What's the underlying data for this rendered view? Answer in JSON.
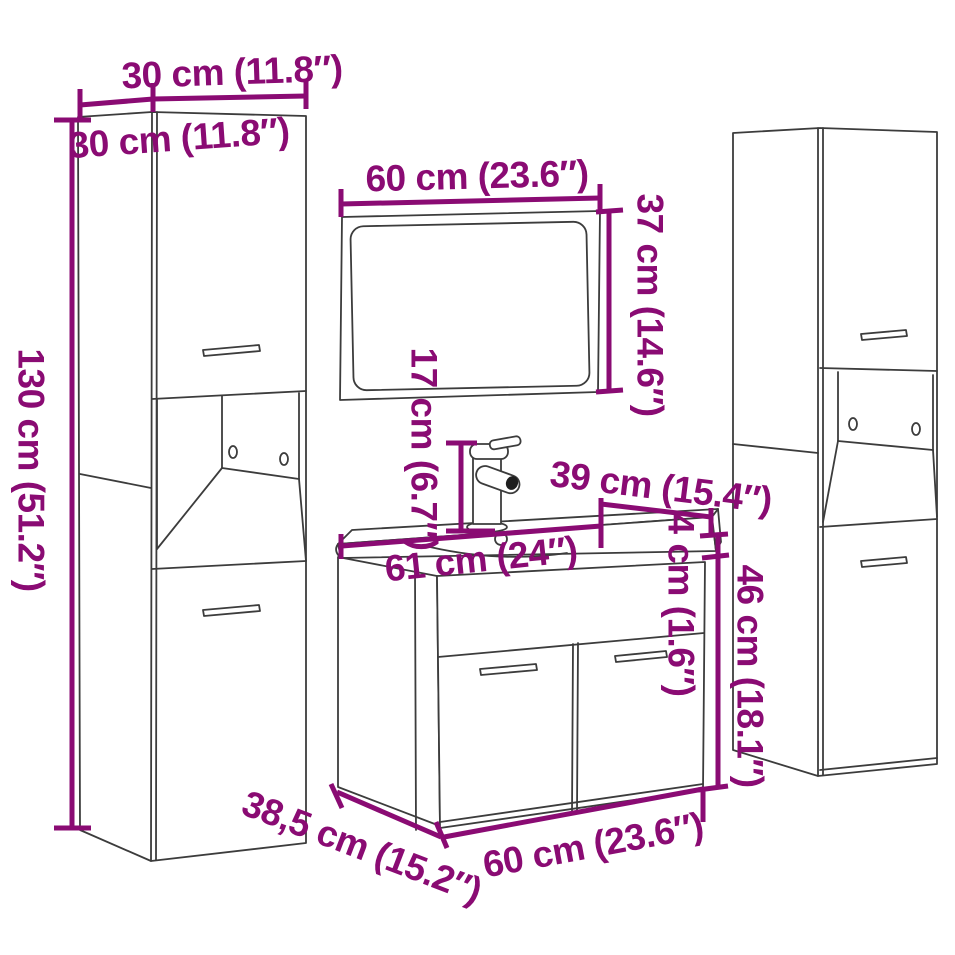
{
  "figure": {
    "kind": "product dimension diagram",
    "subject": "3-piece bathroom furniture set with mirror, washbasin vanity and two tall side cabinets"
  },
  "colors": {
    "dimension": "#8A0B73",
    "line_art": "#3C3C3C",
    "background": "#FFFFFF"
  },
  "dims": {
    "side_cabinet_width": "30 cm (11.8″)",
    "side_cabinet_depth": "30 cm (11.8″)",
    "side_cabinet_height": "130 cm (51.2″)",
    "mirror_width": "60 cm (23.6″)",
    "mirror_height": "37 cm (14.6″)",
    "faucet_height": "17 cm (6.7″)",
    "basin_depth": "39 cm (15.4″)",
    "basin_width": "61 cm (24″)",
    "basin_thickness": "4 cm (1.6″)",
    "vanity_height": "46 cm (18.1″)",
    "vanity_depth": "38,5 cm (15.2″)",
    "vanity_width": "60 cm (23.6″)"
  }
}
